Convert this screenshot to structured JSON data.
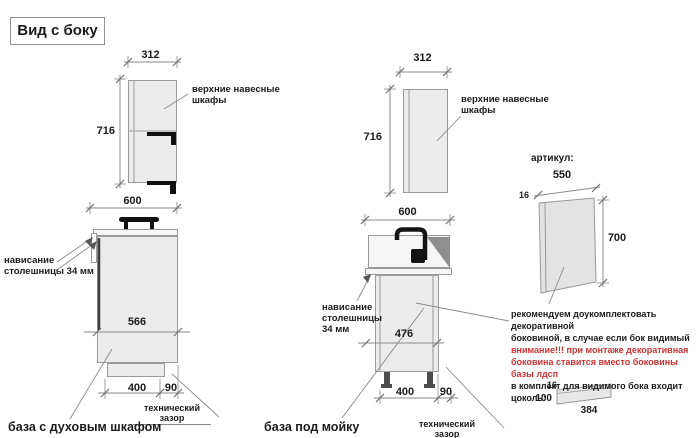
{
  "title": "Вид с боку",
  "wall_left": {
    "width": "312",
    "height": "716",
    "note": "верхние навесные\nшкафы",
    "base_width": "600"
  },
  "base_oven": {
    "overhang_note": "нависание\nстолешницы 34 мм",
    "depth": "566",
    "plinth_depth": "400",
    "gap": "90",
    "gap_note": "технический зазор",
    "caption": "база с духовым шкафом"
  },
  "wall_mid": {
    "width": "312",
    "height": "716",
    "note": "верхние навесные\nшкафы",
    "base_width": "600"
  },
  "base_sink": {
    "overhang_note": "нависание\nстолешницы\n34 мм",
    "depth": "476",
    "plinth_depth": "400",
    "gap": "90",
    "gap_note": "технический зазор",
    "caption": "база под мойку"
  },
  "side_panel": {
    "article_label": "артикул:",
    "width": "550",
    "thickness": "16",
    "height": "700"
  },
  "recommendation": {
    "lines": [
      "рекомендуем доукомплектовать декоративной",
      "боковиной, в случае если бок видимый",
      "внимание!!! при монтаже декоративная",
      "боковина ставится вместо боковины базы лдсп",
      "в комплект для видимого бока входит цоколь:"
    ]
  },
  "plinth_part": {
    "thickness": "16",
    "height": "100",
    "length": "384"
  },
  "colors": {
    "accent_red": "#cc3333",
    "cabinet_fill": "#ececec",
    "dim_line": "#8a8a8a"
  }
}
